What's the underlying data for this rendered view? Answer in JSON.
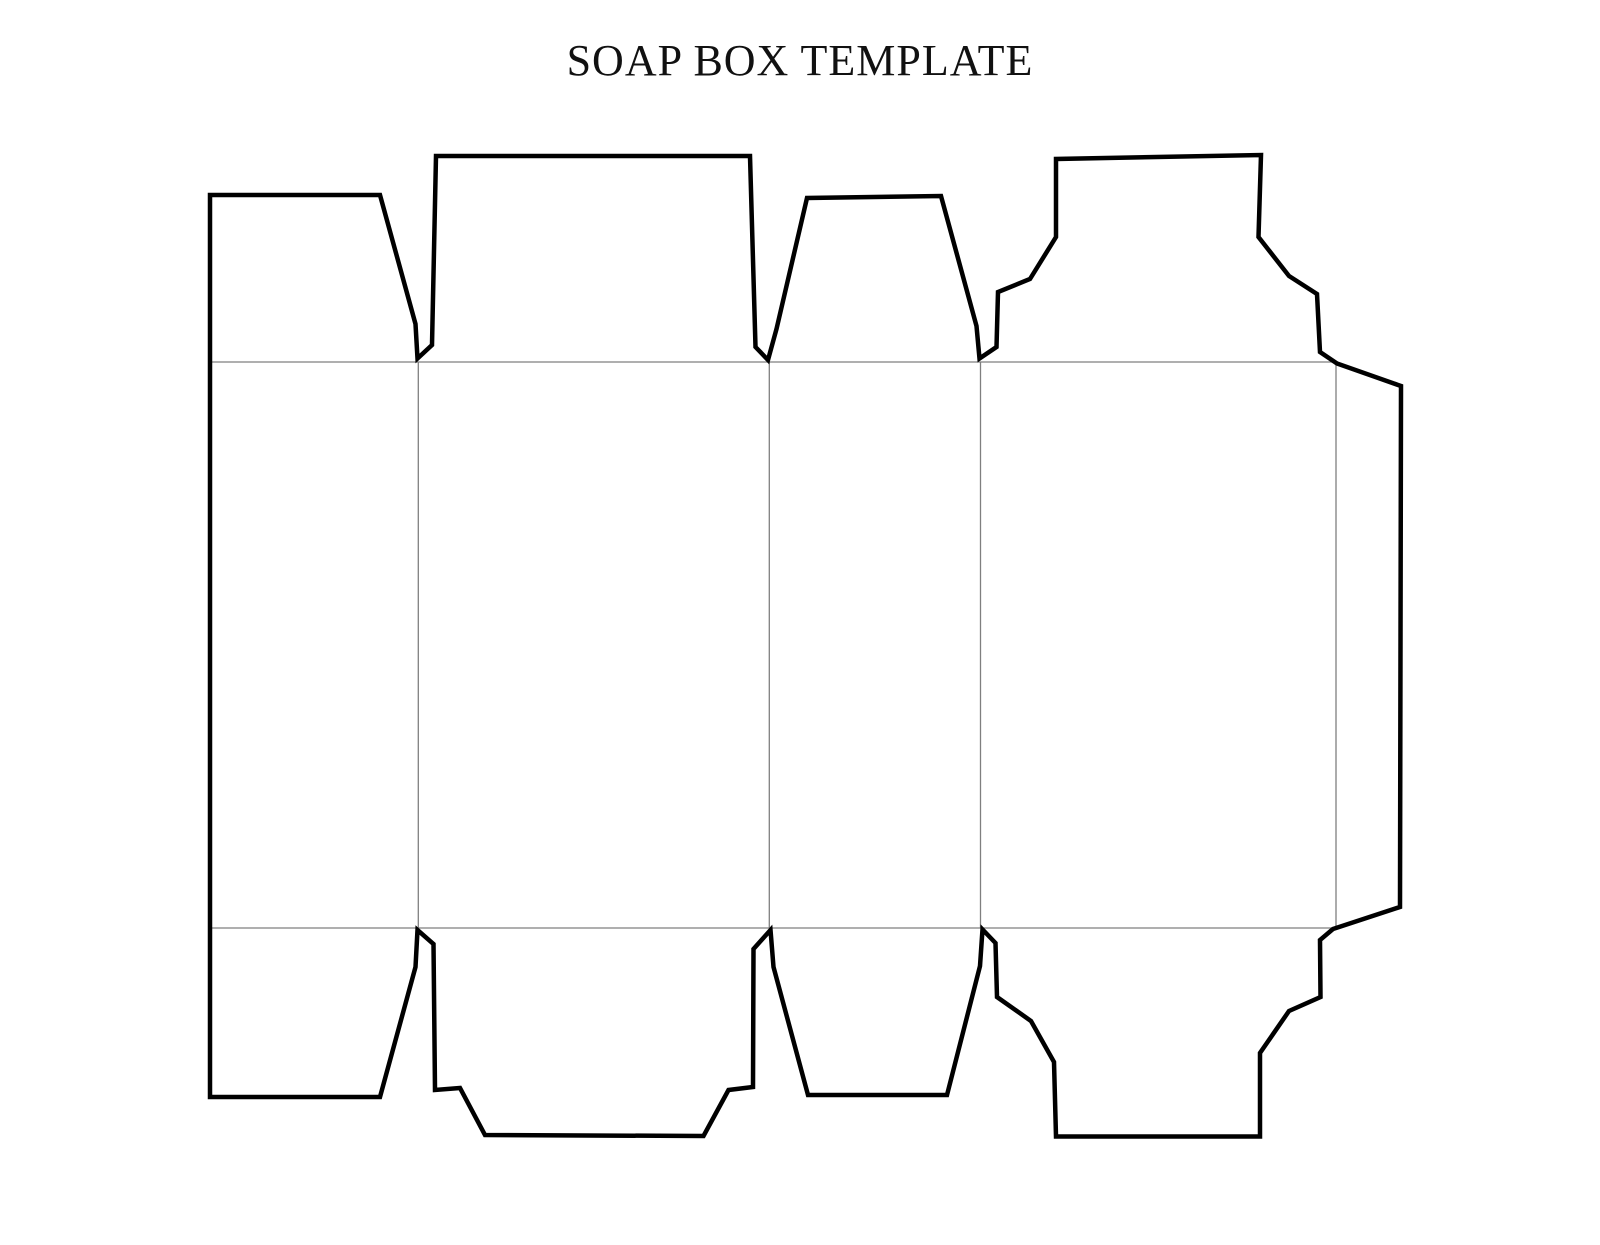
{
  "page": {
    "title": "SOAP BOX TEMPLATE",
    "background_color": "#ffffff"
  },
  "diagram": {
    "description_name": "soap-box-die-cut-template",
    "canvas": {
      "width": 1600,
      "height": 1245
    },
    "styles": {
      "cut_line_color": "#000000",
      "cut_line_width": 4.5,
      "fold_line_color": "#7f7f7f",
      "fold_line_width": 1.3,
      "fill_color": "#ffffff"
    },
    "cut_outline_points": [
      [
        210,
        195
      ],
      [
        380,
        195
      ],
      [
        415.5,
        324
      ],
      [
        417.5,
        358.5
      ],
      [
        432,
        345
      ],
      [
        436,
        156
      ],
      [
        750,
        156
      ],
      [
        755.5,
        347
      ],
      [
        768,
        360
      ],
      [
        776.5,
        329
      ],
      [
        807,
        198
      ],
      [
        941,
        196
      ],
      [
        976.5,
        326
      ],
      [
        979.5,
        358.5
      ],
      [
        996.5,
        347
      ],
      [
        998,
        292
      ],
      [
        1030,
        279
      ],
      [
        1056,
        237
      ],
      [
        1056,
        159
      ],
      [
        1261,
        155
      ],
      [
        1258.5,
        237
      ],
      [
        1289,
        276
      ],
      [
        1317,
        294
      ],
      [
        1320,
        352
      ],
      [
        1337,
        363.5
      ],
      [
        1401,
        386
      ],
      [
        1400,
        907
      ],
      [
        1333,
        929
      ],
      [
        1320,
        940
      ],
      [
        1320.5,
        997
      ],
      [
        1289,
        1011
      ],
      [
        1260,
        1053
      ],
      [
        1260,
        1136.5
      ],
      [
        1056,
        1136.5
      ],
      [
        1054,
        1062
      ],
      [
        1031,
        1021
      ],
      [
        997,
        997
      ],
      [
        995.5,
        943
      ],
      [
        982.5,
        929.5
      ],
      [
        980,
        966
      ],
      [
        947,
        1095
      ],
      [
        808,
        1095
      ],
      [
        773.5,
        967
      ],
      [
        770.5,
        930
      ],
      [
        753.5,
        949
      ],
      [
        753,
        1087
      ],
      [
        728.5,
        1090
      ],
      [
        703.5,
        1136
      ],
      [
        485,
        1135
      ],
      [
        460,
        1088
      ],
      [
        435,
        1090
      ],
      [
        433.5,
        944
      ],
      [
        417.5,
        930
      ],
      [
        415.5,
        967
      ],
      [
        380,
        1097
      ],
      [
        210,
        1097
      ]
    ],
    "fold_lines": [
      {
        "name": "fold-top-horizontal",
        "x1": 210,
        "y1": 362,
        "x2": 1336,
        "y2": 362
      },
      {
        "name": "fold-bottom-horizontal",
        "x1": 210,
        "y1": 928,
        "x2": 1336,
        "y2": 928
      },
      {
        "name": "fold-vertical-1",
        "x1": 418.3,
        "y1": 362,
        "x2": 418.3,
        "y2": 928
      },
      {
        "name": "fold-vertical-2",
        "x1": 769.3,
        "y1": 362,
        "x2": 769.3,
        "y2": 928
      },
      {
        "name": "fold-vertical-3",
        "x1": 980.5,
        "y1": 362,
        "x2": 980.5,
        "y2": 928
      },
      {
        "name": "fold-vertical-4",
        "x1": 1336,
        "y1": 362,
        "x2": 1336,
        "y2": 928
      }
    ]
  }
}
